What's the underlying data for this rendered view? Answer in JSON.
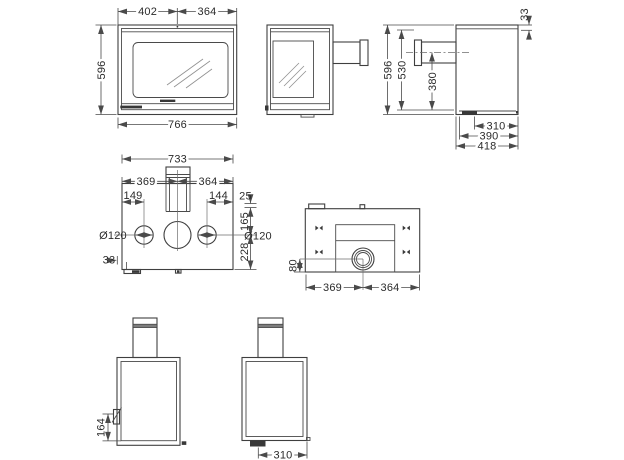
{
  "drawing": {
    "views": {
      "front": {
        "dims": {
          "left_width": "402",
          "right_width": "364",
          "height": "596",
          "total_width": "766"
        }
      },
      "rear_side": {
        "dims": {
          "top_offset": "33",
          "height": "596",
          "body_height": "530",
          "flue_axis_height": "380",
          "depth_foot": "310",
          "depth_inner": "390",
          "depth_total": "418"
        }
      },
      "top": {
        "dims": {
          "total_width": "733",
          "left_to_flue": "369",
          "flue_to_right": "364",
          "left_outlet_offset": "149",
          "right_outlet_offset": "144",
          "front_gap": "25",
          "flue_axis_depth": "165",
          "rear_depth": "228",
          "outlet_dia_left": "Ø120",
          "outlet_dia_right": "Ø120",
          "foot_offset": "33"
        }
      },
      "bottom": {
        "dims": {
          "outlet_axis_offset": "80",
          "left_to_axis": "369",
          "axis_to_right": "364"
        }
      },
      "rear": {
        "dims": {
          "latch_height": "164"
        }
      },
      "side_feet": {
        "dims": {
          "foot_depth": "310"
        }
      }
    }
  }
}
